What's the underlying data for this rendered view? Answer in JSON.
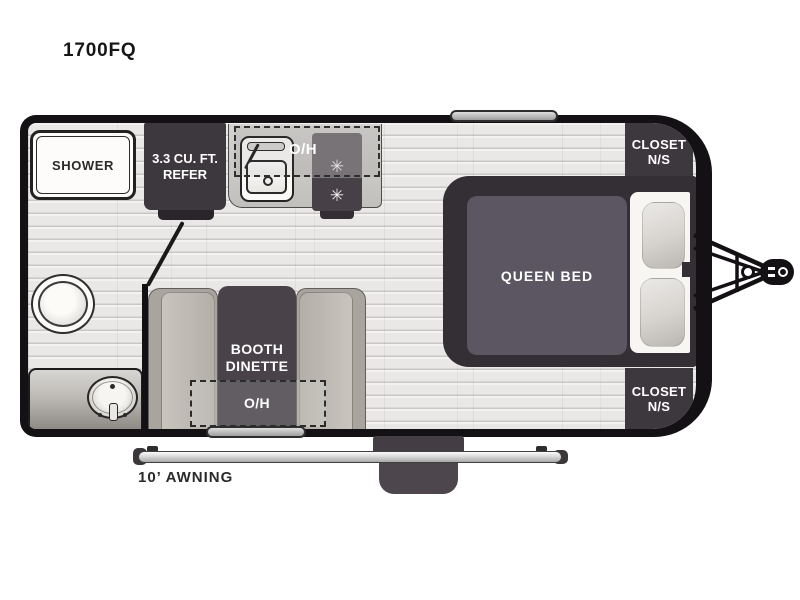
{
  "title": "1700FQ",
  "floorplan": {
    "shower": {
      "label": "SHOWER"
    },
    "refrigerator": {
      "line1": "3.3 CU. FT.",
      "line2": "REFER"
    },
    "kitchen": {
      "overhead_label": "O/H"
    },
    "closet_top": {
      "line1": "CLOSET",
      "line2": "N/S"
    },
    "closet_bottom": {
      "line1": "CLOSET",
      "line2": "N/S"
    },
    "bed": {
      "label": "QUEEN BED"
    },
    "dinette": {
      "line1": "BOOTH",
      "line2": "DINETTE",
      "overhead_label": "O/H"
    },
    "awning": {
      "label": "10’ AWNING"
    }
  },
  "icons": {
    "burner": "✳"
  },
  "colors": {
    "wall": "#141114",
    "dark_cabinet": "#3d383d",
    "bed_frame": "#332f35",
    "mattress": "#5b5661",
    "table": "#494349",
    "bench": "#b3afa8",
    "counter": "#c9c7c4",
    "floor": "#e9e8e6",
    "label_light": "#ffffff",
    "label_dark": "#2c2a2c"
  }
}
